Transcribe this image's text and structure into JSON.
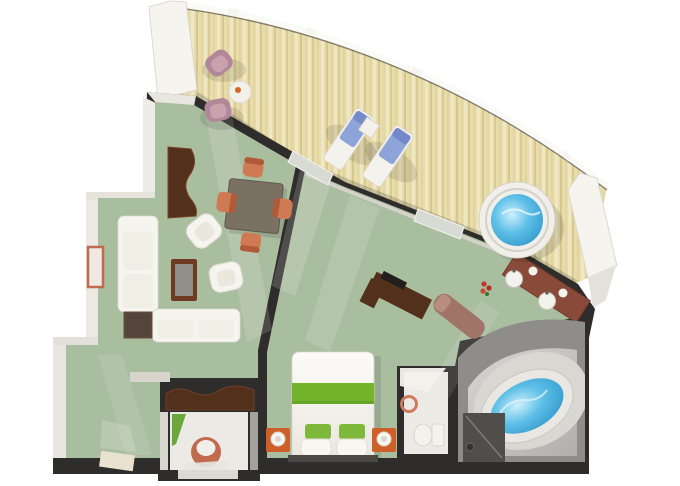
{
  "scene": {
    "type": "floor-plan-3d-render",
    "rooms": [
      {
        "name": "balcony",
        "furniture": [
          "armchair",
          "armchair",
          "round-table",
          "sun-lounger",
          "sun-lounger",
          "side-table",
          "hot-tub"
        ]
      },
      {
        "name": "living-room",
        "furniture": [
          "writing-desk",
          "dining-table",
          "dining-chair",
          "dining-chair",
          "dining-chair",
          "dining-chair",
          "sofa",
          "chaise-sofa",
          "armchair",
          "armchair",
          "coffee-table",
          "side-table",
          "wall-picture"
        ]
      },
      {
        "name": "entry-hall",
        "furniture": [
          "console"
        ]
      },
      {
        "name": "guest-wc",
        "furniture": [
          "washbasin",
          "vanity-tray"
        ]
      },
      {
        "name": "bedroom",
        "furniture": [
          "double-bed",
          "nightstand",
          "nightstand",
          "tv-cabinet",
          "chaise-lounge",
          "vanity-double-sink",
          "flowers",
          "bench"
        ]
      },
      {
        "name": "toilet-room",
        "furniture": [
          "toilet",
          "towel-ring"
        ]
      },
      {
        "name": "bathroom",
        "furniture": [
          "oval-bathtub",
          "shower",
          "rubber-duck"
        ]
      }
    ]
  },
  "palette": {
    "background": "#ffffff",
    "balcony_wood": "#e8dcab",
    "partition_white": "#f5f4ef",
    "railing_white": "#fafaf6",
    "wall_dark": "#2f2d2b",
    "carpet_green": "#a9bd9f",
    "floor_white": "#eceae5",
    "bath_wall": "#8f8d89",
    "water_blue": "#5fc0e8",
    "bed_green": "#74b42c",
    "nightstand_orange": "#ce5f28",
    "chair_coral": "#cf7a52",
    "chair_mauve": "#b2879a",
    "lounger_blue": "#8ea4d8",
    "sofa_white": "#f6f4ee",
    "wood_dark": "#53301b",
    "wood_mahogany": "#8a4a3a",
    "accent_coral": "#c26a4e"
  }
}
